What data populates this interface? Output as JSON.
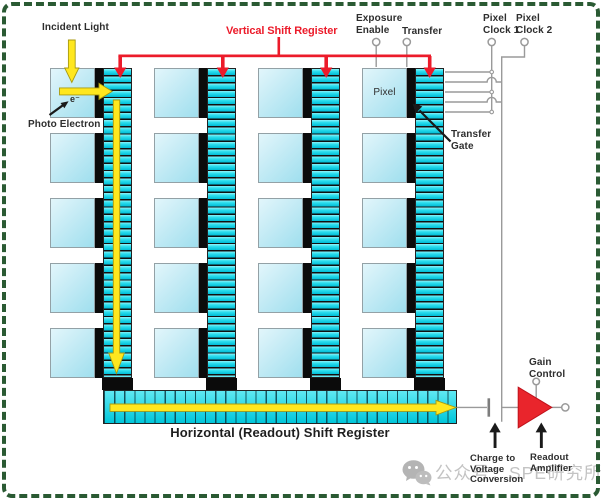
{
  "diagram": {
    "title_context": "CCD sensor architecture diagram",
    "labels": {
      "incident_light": "Incident Light",
      "photo_electron": "Photo Electron",
      "electron": "e⁻",
      "vertical_shift_register": "Vertical Shift Register",
      "exposure_enable": "Exposure\nEnable",
      "transfer": "Transfer",
      "pixel_clock_1": "Pixel\nClock 1",
      "pixel_clock_2": "Pixel\nClock 2",
      "pixel": "Pixel",
      "transfer_gate": "Transfer\nGate",
      "horizontal_shift_register": "Horizontal (Readout) Shift Register",
      "gain_control": "Gain\nControl",
      "charge_to_voltage_conversion": "Charge to\nVoltage\nConversion",
      "readout_amplifier": "Readout\nAmplifier"
    },
    "grid": {
      "columns": 4,
      "rows": 5
    },
    "colors": {
      "register_red": "#ec1b2a",
      "amplifier_red": "#e9252c",
      "arrow_yellow": "#ffe71e",
      "register_cyan": "#00c8dc",
      "pixel_blue": "#bfe9f4",
      "gate_black": "#0b0b0b",
      "wire_gray": "#9a9a9a",
      "border_green": "#2a5a33",
      "watermark_gray": "#b9b9b9"
    },
    "watermark": {
      "text": "公众号：SPE研究所",
      "icon": "wechat-icon"
    }
  }
}
